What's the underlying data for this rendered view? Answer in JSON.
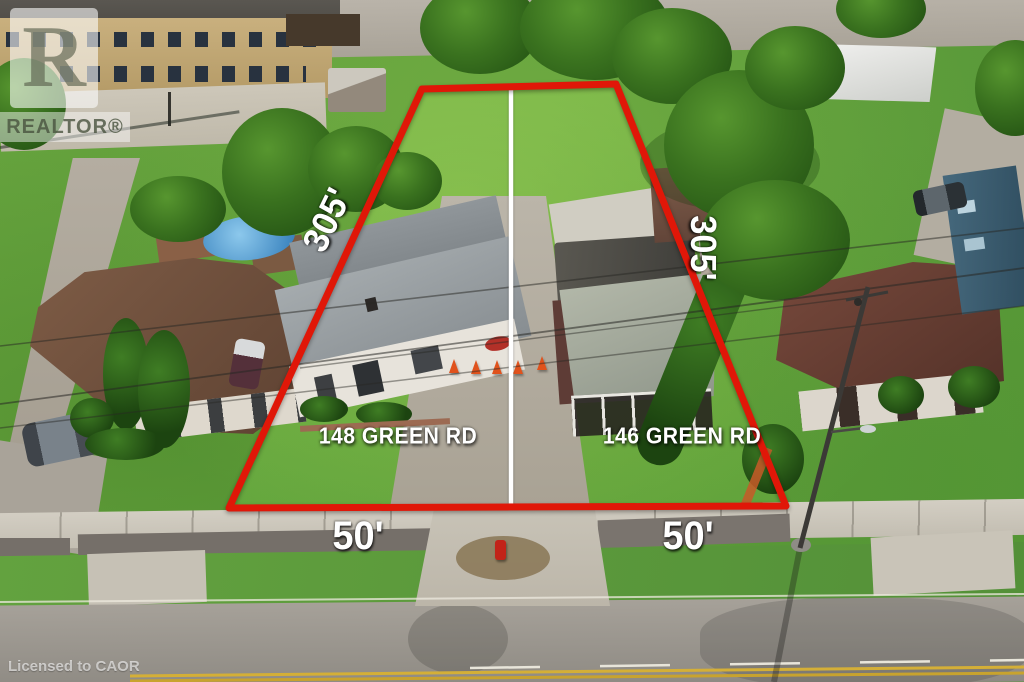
{
  "watermark": {
    "logo_letter": "R",
    "brand": "REALTOR®",
    "license": "Licensed to CAOR"
  },
  "annotations": {
    "depth_left": "305'",
    "depth_right": "305'",
    "frontage_left": "50'",
    "frontage_right": "50'",
    "address_left": "148 GREEN RD",
    "address_right": "146 GREEN RD"
  },
  "colors": {
    "boundary_red": "#e01708",
    "divider_white": "#ffffff",
    "label_text": "#ffffff",
    "cone_orange": "#e0521c",
    "hydrant_red": "#c22318",
    "lawn_green": "#65a33e"
  }
}
